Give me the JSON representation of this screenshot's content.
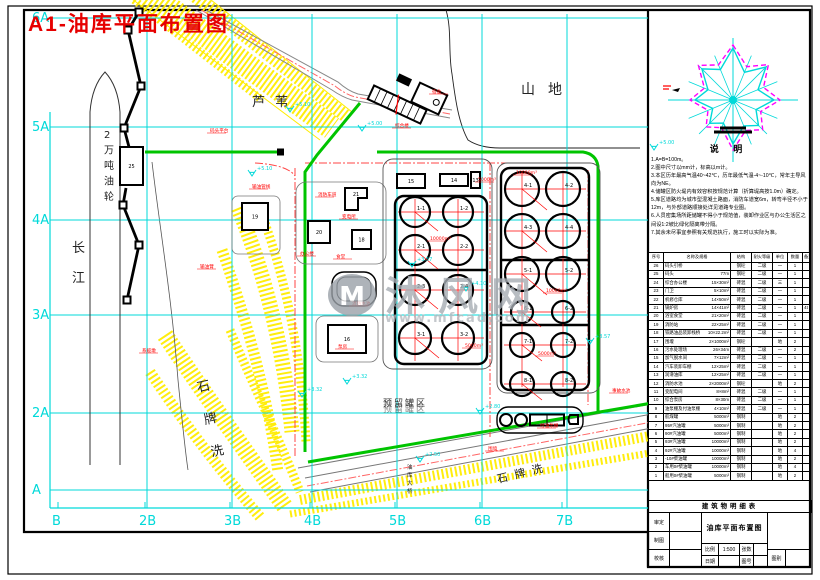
{
  "sheet": {
    "title": "A1-油库平面布置图"
  },
  "colors": {
    "accent_red": "#ff0000",
    "grid_cyan": "#00d9d9",
    "pipe_green": "#00c400",
    "hatch_yellow": "#ffec00",
    "magenta": "#ff00ff",
    "watermark_gray": "#a7adb4"
  },
  "axis": {
    "left": [
      {
        "label": "6A",
        "y": 18
      },
      {
        "label": "5A",
        "y": 127
      },
      {
        "label": "4A",
        "y": 220
      },
      {
        "label": "3A",
        "y": 315
      },
      {
        "label": "2A",
        "y": 413
      },
      {
        "label": "A",
        "y": 490
      }
    ],
    "bottom": [
      {
        "label": "B",
        "x": 58
      },
      {
        "label": "2B",
        "x": 145
      },
      {
        "label": "3B",
        "x": 230
      },
      {
        "label": "4B",
        "x": 310
      },
      {
        "label": "5B",
        "x": 395
      },
      {
        "label": "6B",
        "x": 480
      },
      {
        "label": "7B",
        "x": 562
      }
    ],
    "vlines": [
      147,
      232,
      312,
      397,
      482,
      567
    ]
  },
  "regions": [
    {
      "text": "长江",
      "x": 72,
      "y": 252,
      "size": 13,
      "vertical": true,
      "vspace": 30,
      "color": "#222"
    },
    {
      "text": "2万吨油轮",
      "x": 104,
      "y": 138,
      "size": 10,
      "vertical": true,
      "vspace": 15.5,
      "color": "#222"
    },
    {
      "text": "芦苇",
      "x": 252,
      "y": 106,
      "size": 13,
      "spacing": 10,
      "color": "#222"
    },
    {
      "text": "山地",
      "x": 521,
      "y": 94,
      "size": 14,
      "spacing": 13,
      "color": "#222"
    },
    {
      "text": "石牌洗",
      "x": 198,
      "y": 392,
      "size": 13,
      "vertical": true,
      "vspace": 33,
      "rotate": -12,
      "color": "#222"
    },
    {
      "text": "石牌洗",
      "x": 498,
      "y": 483,
      "size": 11,
      "rotate": -14,
      "spacing": 7,
      "color": "#222"
    },
    {
      "text": "油库大桥",
      "x": 407,
      "y": 469,
      "size": 5.5,
      "vertical": true,
      "vspace": 8,
      "color": "#222"
    },
    {
      "text": "预留罐区",
      "x": 383,
      "y": 406,
      "size": 9,
      "spacing": 2,
      "color": "#333",
      "shadow": true
    }
  ],
  "watermark": {
    "chars": [
      "沐",
      "风",
      "网"
    ],
    "url": "www.mfcad.com",
    "logo": "M"
  },
  "windrose": {
    "heading": "说 明",
    "cyan_points": "733,48 744.5,72.3 766,67 758,89.7 774,100 756,109.6 758.5,125.5 743.7,125.9 733,144 723.4,123.1 709.7,123.3 712.7,108.4 695,100 708,89.7 701.9,68.9 720.4,69.5",
    "magenta_points": "733,45 746.8,66.7 768.4,64.6 763.5,87.4 780,100 760.7,111.5 762.7,129.7 745.6,130.5 733,150 721.5,127.7 706.1,126.9 708,110.3 690,100 704.4,88.1 698.4,65.4 718.4,64.9",
    "cx": 733,
    "cy": 100
  },
  "notes": {
    "lines": [
      "1.A=B=100m。",
      "2.图中尺寸以mm计，标高以m计。",
      "3.本区历年最高气温40~42℃，历年最低气温-4~-10℃，常年主导风向为NE。",
      "4.储罐区防火堤内有效容积按规范计算（折算堤高按1.0m）确定。",
      "5.库区道路均为城市型混凝土路面，消防车道宽6m，转弯半径不小于12m，与外部道路顺接处详见道路专业图。",
      "6.人员密集场所距储罐不得小于规范值，装卸作业区与办公生活区之间设1:2坡比绿化隔离带分隔。",
      "7.其余未尽事宜参照有关规范执行，施工时以实际为准。"
    ]
  },
  "schedule": {
    "heading": "建筑物明细表",
    "header": {
      "no": "序号",
      "name": "名称及规格",
      "struct": "结构",
      "fire": "耐火等级",
      "unit": "单位",
      "qty": "数量",
      "note": "备注"
    },
    "rows": [
      [
        "26",
        "码头引桥",
        "",
        "钢砼",
        "二级",
        "一",
        "1",
        ""
      ],
      [
        "25",
        "码头",
        "77m",
        "钢砼",
        "二级",
        "一",
        "1",
        ""
      ],
      [
        "24",
        "综合办公楼",
        "15×30m²",
        "砖混",
        "二级",
        "三",
        "1",
        ""
      ],
      [
        "23",
        "门卫",
        "5×10m²",
        "砖混",
        "二级",
        "一",
        "1",
        ""
      ],
      [
        "22",
        "机修仓库",
        "14×50m²",
        "砖混",
        "二级",
        "一",
        "1",
        ""
      ],
      [
        "21",
        "锅炉房",
        "14×41m²",
        "砖混",
        "二级",
        "一",
        "1",
        "4t"
      ],
      [
        "20",
        "浴室食堂",
        "21×20m²",
        "砖混",
        "二级",
        "一",
        "1",
        ""
      ],
      [
        "19",
        "消防站",
        "22×25m²",
        "砖混",
        "二级",
        "一",
        "1",
        ""
      ],
      [
        "18",
        "铁路油品装卸栈桥",
        "10×22.2m²",
        "砖混",
        "二级",
        "一",
        "1",
        ""
      ],
      [
        "17",
        "围堰",
        "2×1000m²",
        "钢砼",
        "",
        "地",
        "2",
        ""
      ],
      [
        "16",
        "污水处理场",
        "26×34m",
        "砖混",
        "二级",
        "一",
        "2",
        ""
      ],
      [
        "15",
        "加气脱水间",
        "7×12m²",
        "砖混",
        "二级",
        "一",
        "1",
        ""
      ],
      [
        "14",
        "汽车装卸车棚",
        "12×25m²",
        "砖混",
        "二级",
        "一",
        "1",
        ""
      ],
      [
        "13",
        "润滑油库",
        "12×25m²",
        "砖混",
        "二级",
        "一",
        "1",
        ""
      ],
      [
        "12",
        "消防水池",
        "2×2000m³",
        "钢砼",
        "",
        "地",
        "2",
        ""
      ],
      [
        "11",
        "变配电间",
        "8×8m²",
        "砖混",
        "二级",
        "一",
        "1",
        ""
      ],
      [
        "10",
        "综合泵房",
        "8×30m",
        "砖混",
        "二级",
        "一",
        "1",
        ""
      ],
      [
        "9",
        "油泵棚及付油泵棚",
        "4×10m²",
        "砖混",
        "二级",
        "一",
        "1",
        ""
      ],
      [
        "8",
        "航煤罐",
        "5000m³",
        "钢制",
        "",
        "地",
        "2",
        ""
      ],
      [
        "7",
        "95#汽油罐",
        "5000m³",
        "钢制",
        "",
        "地",
        "2",
        ""
      ],
      [
        "6",
        "90#汽油罐",
        "5000m³",
        "钢制",
        "",
        "地",
        "2",
        ""
      ],
      [
        "5",
        "93#汽油罐",
        "10000m³",
        "钢制",
        "",
        "地",
        "2",
        ""
      ],
      [
        "4",
        "92#汽油罐",
        "10000m³",
        "钢制",
        "",
        "地",
        "4",
        ""
      ],
      [
        "3",
        "-10#柴油罐",
        "10000m³",
        "钢制",
        "",
        "地",
        "2",
        ""
      ],
      [
        "2",
        "车用0#柴油罐",
        "10000m³",
        "钢制",
        "",
        "地",
        "4",
        ""
      ],
      [
        "1",
        "船用0#柴油罐",
        "5000m³",
        "钢制",
        "",
        "地",
        "2",
        ""
      ]
    ]
  },
  "titleblock": {
    "title": "油库平面布置图",
    "left": [
      {
        "k": "审定",
        "v": ""
      },
      {
        "k": "制图",
        "v": ""
      },
      {
        "k": "校核",
        "v": ""
      }
    ],
    "cells": [
      [
        "比例",
        "1:500",
        "张数",
        ""
      ],
      [
        "日期",
        "",
        "图号",
        ""
      ]
    ],
    "right_bottom": [
      "图别",
      ""
    ]
  },
  "plan": {
    "left_farm": {
      "fence": [
        383,
        159,
        109,
        210
      ],
      "dike": [
        395,
        196,
        92,
        168
      ],
      "dividers": [
        270
      ],
      "cols": [
        415,
        458
      ],
      "rows": [
        {
          "y": 212,
          "r": 15,
          "labels": [
            "1-1",
            "1-2"
          ]
        },
        {
          "y": 250,
          "r": 15,
          "labels": [
            "2-1",
            "2-2"
          ]
        },
        {
          "y": 290,
          "r": 15,
          "labels": [
            "2-3",
            "2-4"
          ]
        },
        {
          "y": 338,
          "r": 16,
          "labels": [
            "3-1",
            "3-2"
          ]
        }
      ]
    },
    "right_farm": {
      "fence": [
        497,
        163,
        103,
        230
      ],
      "dike": [
        501,
        168,
        88,
        222
      ],
      "dividers": [
        260,
        325
      ],
      "cols": [
        522,
        563
      ],
      "rows": [
        {
          "y": 189,
          "r": 17,
          "labels": [
            "4-1",
            "4-2"
          ]
        },
        {
          "y": 231,
          "r": 17,
          "labels": [
            "4-3",
            "4-4"
          ]
        },
        {
          "y": 274,
          "r": 17,
          "labels": [
            "5-1",
            "5-2"
          ]
        },
        {
          "y": 312,
          "r": 11,
          "labels": [
            "6-1",
            "6-2"
          ]
        },
        {
          "y": 345,
          "r": 12,
          "labels": [
            "7-1",
            "7-2"
          ]
        },
        {
          "y": 384,
          "r": 12,
          "labels": [
            "8-1",
            "8-2"
          ]
        }
      ]
    },
    "buildings": [
      {
        "x": 397,
        "y": 174,
        "w": 28,
        "h": 14,
        "label": "15"
      },
      {
        "x": 440,
        "y": 174,
        "w": 28,
        "h": 12,
        "label": "14"
      },
      {
        "x": 471,
        "y": 172,
        "w": 9,
        "h": 16,
        "label": "13"
      },
      {
        "x": 308,
        "y": 221,
        "w": 22,
        "h": 22,
        "label": "20"
      },
      {
        "x": 352,
        "y": 230,
        "w": 19,
        "h": 19,
        "label": "18"
      },
      {
        "x": 242,
        "y": 203,
        "w": 26,
        "h": 27,
        "label": "19"
      },
      {
        "x": 328,
        "y": 325,
        "w": 38,
        "h": 28,
        "label": "16"
      },
      {
        "x": 120,
        "y": 147,
        "w": 23,
        "h": 38,
        "label": "25"
      }
    ],
    "l_building_label": "21",
    "markers": [
      {
        "x": 252,
        "y": 176,
        "t": "+5.10"
      },
      {
        "x": 362,
        "y": 131,
        "t": "+5.00"
      },
      {
        "x": 290,
        "y": 112,
        "t": "+5.10"
      },
      {
        "x": 412,
        "y": 267,
        "t": "+3.57"
      },
      {
        "x": 466,
        "y": 291,
        "t": "+4.10"
      },
      {
        "x": 347,
        "y": 384,
        "t": "+3.32"
      },
      {
        "x": 590,
        "y": 344,
        "t": "+3.57"
      },
      {
        "x": 480,
        "y": 414,
        "t": "+2.80"
      },
      {
        "x": 302,
        "y": 397,
        "t": "+3.32"
      },
      {
        "x": 654,
        "y": 150,
        "t": "+5.00"
      },
      {
        "x": 420,
        "y": 462,
        "t": "+2.50"
      }
    ],
    "tags": [
      {
        "x": 210,
        "y": 132,
        "t": "码头平台"
      },
      {
        "x": 200,
        "y": 268,
        "t": "输油臂"
      },
      {
        "x": 142,
        "y": 352,
        "t": "系缆墩"
      },
      {
        "x": 252,
        "y": 188,
        "t": "输油管线"
      },
      {
        "x": 318,
        "y": 196,
        "t": "消防车道"
      },
      {
        "x": 342,
        "y": 218,
        "t": "变电所"
      },
      {
        "x": 300,
        "y": 255,
        "t": "办公楼"
      },
      {
        "x": 336,
        "y": 258,
        "t": "食堂"
      },
      {
        "x": 395,
        "y": 127,
        "t": "综合楼"
      },
      {
        "x": 432,
        "y": 93,
        "t": "宿舍"
      },
      {
        "x": 352,
        "y": 305,
        "t": "消防水池"
      },
      {
        "x": 338,
        "y": 348,
        "t": "泵房"
      },
      {
        "x": 478,
        "y": 181,
        "t": "5000m³"
      },
      {
        "x": 430,
        "y": 240,
        "t": "10000m³"
      },
      {
        "x": 465,
        "y": 347,
        "t": "5000m³"
      },
      {
        "x": 516,
        "y": 174,
        "t": "10000m³"
      },
      {
        "x": 546,
        "y": 292,
        "t": "10000m³"
      },
      {
        "x": 538,
        "y": 355,
        "t": "5000m³"
      },
      {
        "x": 540,
        "y": 427,
        "t": "付油泵棚"
      },
      {
        "x": 612,
        "y": 392,
        "t": "事故水池"
      },
      {
        "x": 488,
        "y": 450,
        "t": "围墙"
      }
    ]
  }
}
